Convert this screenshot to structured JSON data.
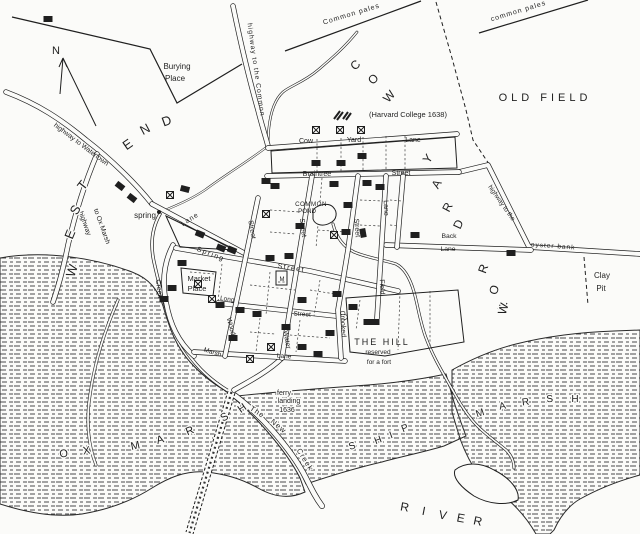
{
  "map": {
    "title": "Plan of Newtowne (Cambridge) with Harvard College 1638",
    "colors": {
      "ink": "#1f1f1f",
      "paper": "#fbfbf9",
      "marsh_dash": "#4a4a4a"
    },
    "compass": {
      "label": "N"
    },
    "labels": [
      {
        "id": "compass-n",
        "text": "N",
        "x": 56,
        "y": 54,
        "rot": 0,
        "size": 11
      },
      {
        "id": "burying-place-1",
        "text": "Burying",
        "x": 177,
        "y": 69,
        "size": 8
      },
      {
        "id": "burying-place-2",
        "text": "Place",
        "x": 175,
        "y": 81,
        "size": 8
      },
      {
        "id": "highway-to-the-common",
        "text": "highway  to  the  Common",
        "x": 254,
        "y": 70,
        "rot": 82,
        "size": 6.8,
        "ls": 1
      },
      {
        "id": "common-pales-left",
        "text": "Common  pales",
        "x": 352,
        "y": 16,
        "rot": -17,
        "size": 7,
        "ls": 1
      },
      {
        "id": "common-pales-right",
        "text": "common  pales",
        "x": 519,
        "y": 13,
        "rot": -17,
        "size": 7,
        "ls": 1
      },
      {
        "id": "harvard-college",
        "text": "(Harvard College 1638)",
        "x": 408,
        "y": 117,
        "size": 7.5
      },
      {
        "id": "old-field",
        "text": "OLD  FIELD",
        "x": 545,
        "y": 101,
        "size": 11,
        "ls": 4
      },
      {
        "id": "highway-to-watertown",
        "text": "highway  to  Watertown",
        "x": 80,
        "y": 146,
        "rot": 37,
        "size": 6.8
      },
      {
        "id": "highway-ox-1",
        "text": "highway",
        "x": 83,
        "y": 224,
        "rot": 70,
        "size": 6.8
      },
      {
        "id": "highway-ox-2",
        "text": "to Ox Marsh",
        "x": 100,
        "y": 227,
        "rot": 70,
        "size": 6.8
      },
      {
        "id": "spring",
        "text": "spring",
        "x": 145,
        "y": 218,
        "size": 8
      },
      {
        "id": "cow-yard-lane-1",
        "text": "Cow",
        "x": 306,
        "y": 143,
        "size": 7
      },
      {
        "id": "cow-yard-lane-2",
        "text": "Yard",
        "x": 354,
        "y": 142,
        "size": 7
      },
      {
        "id": "cow-yard-lane-3",
        "text": "Lane",
        "x": 413,
        "y": 142,
        "size": 7
      },
      {
        "id": "braintree-street-1",
        "text": "Braintree",
        "x": 317,
        "y": 176,
        "size": 7
      },
      {
        "id": "braintree-street-2",
        "text": "Street",
        "x": 401,
        "y": 175,
        "size": 7
      },
      {
        "id": "common-pond-1",
        "text": "COMMON",
        "x": 311,
        "y": 206,
        "size": 6.2,
        "ls": 0.5
      },
      {
        "id": "common-pond-2",
        "text": "POND",
        "x": 307,
        "y": 213,
        "size": 6.2
      },
      {
        "id": "water-street-1",
        "text": "Street",
        "x": 301,
        "y": 228,
        "rot": 83,
        "size": 7
      },
      {
        "id": "water-street-2",
        "text": "Water",
        "x": 285,
        "y": 340,
        "rot": 80,
        "size": 7
      },
      {
        "id": "wood-street-1",
        "text": "Street",
        "x": 250,
        "y": 230,
        "rot": 80,
        "size": 7
      },
      {
        "id": "wood-street-2",
        "text": "Wood",
        "x": 229,
        "y": 327,
        "rot": 75,
        "size": 7
      },
      {
        "id": "crooked-street-1",
        "text": "Street",
        "x": 355,
        "y": 228,
        "rot": 85,
        "size": 7
      },
      {
        "id": "crooked-street-2",
        "text": "Crooked",
        "x": 341,
        "y": 324,
        "rot": 87,
        "size": 7
      },
      {
        "id": "field-lane-1",
        "text": "Lane",
        "x": 384,
        "y": 208,
        "rot": 88,
        "size": 7
      },
      {
        "id": "field-lane-2",
        "text": "Field",
        "x": 380,
        "y": 287,
        "rot": 88,
        "size": 7
      },
      {
        "id": "spring-street-1",
        "text": "Spring",
        "x": 210,
        "y": 256,
        "rot": 21,
        "size": 7,
        "ls": 1.5
      },
      {
        "id": "spring-street-2",
        "text": "Street",
        "x": 291,
        "y": 270,
        "rot": 9,
        "size": 7,
        "ls": 1.5
      },
      {
        "id": "creek-lane-1",
        "text": "Lane",
        "x": 191,
        "y": 221,
        "rot": -33,
        "size": 7,
        "ls": 1
      },
      {
        "id": "creek-lane-2",
        "text": "Creek",
        "x": 157,
        "y": 289,
        "rot": 83,
        "size": 7
      },
      {
        "id": "market-place-1",
        "text": "Market",
        "x": 199,
        "y": 281,
        "size": 7.5
      },
      {
        "id": "market-place-2",
        "text": "Place",
        "x": 197,
        "y": 291,
        "size": 7.5
      },
      {
        "id": "long-street-1",
        "text": "Long",
        "x": 227,
        "y": 301,
        "rot": 8,
        "size": 6.5
      },
      {
        "id": "long-street-2",
        "text": "Street",
        "x": 302,
        "y": 316,
        "rot": 4,
        "size": 6.5
      },
      {
        "id": "marsh-lane-1",
        "text": "Marsh",
        "x": 212,
        "y": 354,
        "rot": 17,
        "size": 6.5
      },
      {
        "id": "marsh-lane-2",
        "text": "Lane",
        "x": 284,
        "y": 358,
        "rot": 4,
        "size": 6.5
      },
      {
        "id": "back-lane-1",
        "text": "Back",
        "x": 449,
        "y": 238,
        "size": 6.8
      },
      {
        "id": "back-lane-2",
        "text": "Lane",
        "x": 448,
        "y": 251,
        "size": 6.8
      },
      {
        "id": "highway-oyster-1",
        "text": "highway  to  the",
        "x": 500,
        "y": 204,
        "rot": 55,
        "size": 6.5
      },
      {
        "id": "highway-oyster-2",
        "text": "oyster   bank",
        "x": 553,
        "y": 248,
        "rot": 4,
        "size": 6.5,
        "ls": 1
      },
      {
        "id": "clay-pit-1",
        "text": "Clay",
        "x": 602,
        "y": 278,
        "size": 8
      },
      {
        "id": "clay-pit-2",
        "text": "Pit",
        "x": 601,
        "y": 291,
        "size": 8
      },
      {
        "id": "the-hill-1",
        "text": "THE  HILL",
        "x": 382,
        "y": 345,
        "size": 9,
        "ls": 2
      },
      {
        "id": "the-hill-2",
        "text": "reserved",
        "x": 378,
        "y": 354,
        "size": 6.5
      },
      {
        "id": "the-hill-3",
        "text": "for a fort",
        "x": 379,
        "y": 364,
        "size": 6.5
      },
      {
        "id": "ferry-landing-1",
        "text": "ferry",
        "x": 284,
        "y": 395,
        "size": 7,
        "halo": true
      },
      {
        "id": "ferry-landing-2",
        "text": "landing",
        "x": 289,
        "y": 403,
        "size": 7,
        "halo": true
      },
      {
        "id": "ferry-landing-3",
        "text": "1636",
        "x": 287,
        "y": 412,
        "size": 7,
        "halo": true
      },
      {
        "id": "new-creek-1",
        "text": "The",
        "x": 256,
        "y": 414,
        "rot": 33,
        "size": 7.5,
        "ls": 1,
        "halo": true
      },
      {
        "id": "new-creek-2",
        "text": "New",
        "x": 277,
        "y": 428,
        "rot": 40,
        "size": 7.5,
        "ls": 1,
        "halo": true
      },
      {
        "id": "new-creek-3",
        "text": "Creek",
        "x": 303,
        "y": 461,
        "rot": 58,
        "size": 7.5,
        "ls": 1,
        "halo": true
      },
      {
        "id": "meeting-house-m",
        "text": "M",
        "x": 282,
        "y": 281,
        "size": 6
      }
    ],
    "letter_groups": [
      {
        "name": "west-end",
        "text": "WEST END",
        "size": 13,
        "letters": [
          {
            "ch": "W",
            "x": 76,
            "y": 272,
            "rot": -72
          },
          {
            "ch": "E",
            "x": 74,
            "y": 236,
            "rot": -68
          },
          {
            "ch": "S",
            "x": 79,
            "y": 212,
            "rot": -60
          },
          {
            "ch": "T",
            "x": 86,
            "y": 188,
            "rot": -52
          },
          {
            "ch": "E",
            "x": 130,
            "y": 148,
            "rot": -35
          },
          {
            "ch": "N",
            "x": 147,
            "y": 133,
            "rot": -28
          },
          {
            "ch": "D",
            "x": 168,
            "y": 125,
            "rot": -20
          }
        ]
      },
      {
        "name": "cow-yard-row",
        "text": "COW YARD ROW",
        "size": 12,
        "letters": [
          {
            "ch": "C",
            "x": 358,
            "y": 68,
            "rot": -42
          },
          {
            "ch": "O",
            "x": 376,
            "y": 82,
            "rot": -45
          },
          {
            "ch": "W",
            "x": 392,
            "y": 99,
            "rot": -48
          },
          {
            "ch": "Y",
            "x": 431,
            "y": 161,
            "rot": -55
          },
          {
            "ch": "A",
            "x": 440,
            "y": 186,
            "rot": -60
          },
          {
            "ch": "R",
            "x": 451,
            "y": 209,
            "rot": -62
          },
          {
            "ch": "D",
            "x": 462,
            "y": 226,
            "rot": -65
          },
          {
            "ch": "R",
            "x": 487,
            "y": 270,
            "rot": -70
          },
          {
            "ch": "O",
            "x": 498,
            "y": 291,
            "rot": -72
          },
          {
            "ch": "W",
            "x": 507,
            "y": 310,
            "rot": -74
          }
        ]
      },
      {
        "name": "ox-marsh",
        "text": "OX MARSH",
        "size": 11,
        "letters": [
          {
            "ch": "O",
            "x": 64,
            "y": 457,
            "rot": -6
          },
          {
            "ch": "X",
            "x": 87,
            "y": 454,
            "rot": -8
          },
          {
            "ch": "M",
            "x": 136,
            "y": 449,
            "rot": -12
          },
          {
            "ch": "A",
            "x": 161,
            "y": 443,
            "rot": -16
          },
          {
            "ch": "R",
            "x": 191,
            "y": 434,
            "rot": -22
          },
          {
            "ch": "S",
            "x": 226,
            "y": 420,
            "rot": -30
          },
          {
            "ch": "H",
            "x": 244,
            "y": 411,
            "rot": -35
          }
        ]
      },
      {
        "name": "ship-marsh-ship",
        "text": "SHIP",
        "size": 10,
        "letters": [
          {
            "ch": "S",
            "x": 353,
            "y": 449,
            "rot": -18
          },
          {
            "ch": "H",
            "x": 379,
            "y": 443,
            "rot": -20
          },
          {
            "ch": "I",
            "x": 392,
            "y": 438,
            "rot": -20
          },
          {
            "ch": "P",
            "x": 406,
            "y": 431,
            "rot": -22
          }
        ]
      },
      {
        "name": "ship-marsh-marsh",
        "text": "MARSH",
        "size": 10,
        "letters": [
          {
            "ch": "M",
            "x": 481,
            "y": 416,
            "rot": -18
          },
          {
            "ch": "A",
            "x": 503,
            "y": 409,
            "rot": -12
          },
          {
            "ch": "R",
            "x": 526,
            "y": 405,
            "rot": -8
          },
          {
            "ch": "S",
            "x": 550,
            "y": 402,
            "rot": -4
          },
          {
            "ch": "H",
            "x": 575,
            "y": 402,
            "rot": 0
          }
        ]
      },
      {
        "name": "river",
        "text": "RIVER",
        "size": 12,
        "letters": [
          {
            "ch": "R",
            "x": 404,
            "y": 511,
            "rot": 10
          },
          {
            "ch": "I",
            "x": 423,
            "y": 515,
            "rot": 11
          },
          {
            "ch": "V",
            "x": 442,
            "y": 519,
            "rot": 11
          },
          {
            "ch": "E",
            "x": 460,
            "y": 522,
            "rot": 11
          },
          {
            "ch": "R",
            "x": 477,
            "y": 525,
            "rot": 12
          }
        ]
      }
    ],
    "houses": [
      [
        48,
        19,
        0
      ],
      [
        120,
        186,
        38
      ],
      [
        132,
        198,
        38
      ],
      [
        185,
        189,
        15
      ],
      [
        316,
        163,
        0
      ],
      [
        341,
        163,
        0
      ],
      [
        362,
        156,
        0
      ],
      [
        266,
        181,
        0
      ],
      [
        275,
        186,
        0
      ],
      [
        200,
        234,
        22
      ],
      [
        221,
        248,
        22
      ],
      [
        232,
        250,
        22
      ],
      [
        182,
        263,
        0
      ],
      [
        334,
        184,
        0
      ],
      [
        367,
        183,
        0
      ],
      [
        380,
        187,
        0
      ],
      [
        300,
        226,
        0
      ],
      [
        348,
        205,
        0
      ],
      [
        346,
        232,
        0
      ],
      [
        363,
        233,
        80
      ],
      [
        289,
        256,
        0
      ],
      [
        270,
        258,
        0
      ],
      [
        164,
        299,
        0
      ],
      [
        172,
        288,
        0
      ],
      [
        257,
        314,
        0
      ],
      [
        302,
        300,
        0
      ],
      [
        240,
        310,
        0
      ],
      [
        220,
        305,
        0
      ],
      [
        233,
        338,
        0
      ],
      [
        286,
        327,
        0
      ],
      [
        330,
        333,
        0
      ],
      [
        302,
        347,
        0
      ],
      [
        318,
        354,
        0
      ],
      [
        353,
        307,
        0
      ],
      [
        368,
        322,
        0
      ],
      [
        337,
        294,
        0
      ],
      [
        375,
        322,
        0
      ],
      [
        415,
        235,
        0
      ],
      [
        511,
        253,
        0
      ]
    ],
    "crosses": [
      [
        170,
        195
      ],
      [
        316,
        130
      ],
      [
        340,
        130
      ],
      [
        361,
        130
      ],
      [
        266,
        214
      ],
      [
        198,
        284
      ],
      [
        212,
        299
      ],
      [
        271,
        347
      ],
      [
        250,
        359
      ],
      [
        334,
        235
      ]
    ]
  }
}
